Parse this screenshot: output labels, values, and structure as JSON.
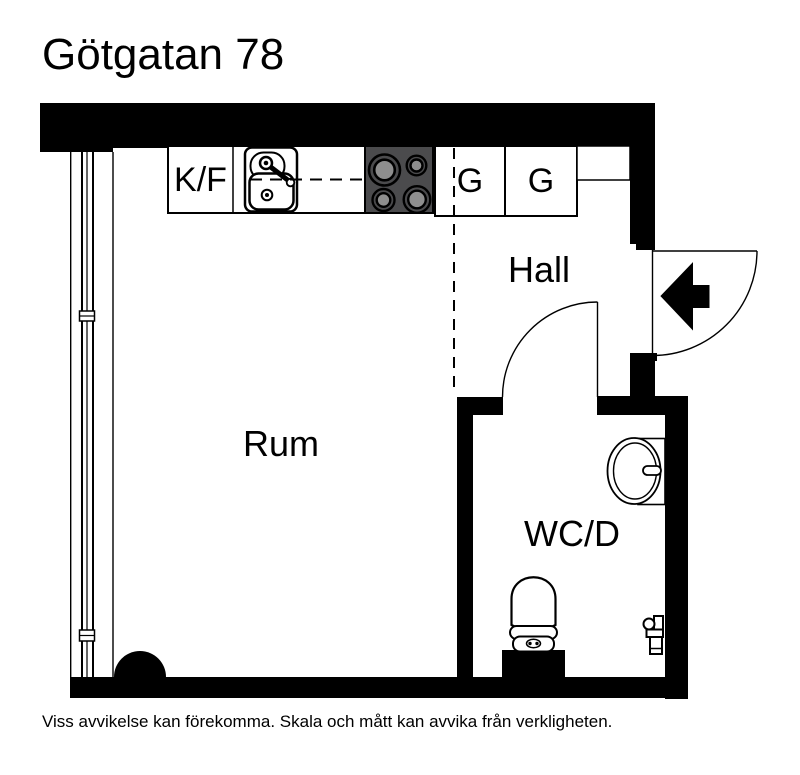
{
  "title": "Götgatan 78",
  "rooms": {
    "main": "Rum",
    "hall": "Hall",
    "bathroom": "WC/D"
  },
  "kitchen": {
    "fridge_freezer": "K/F",
    "wardrobe_1": "G",
    "wardrobe_2": "G"
  },
  "footer": {
    "disclaimer": "Viss avvikelse kan förekomma. Skala och mått kan avvika från verkligheten."
  },
  "colors": {
    "wall": "#000000",
    "background": "#ffffff",
    "stove_fill": "#4b4b4d",
    "burner_fill": "#8e8e8e"
  }
}
